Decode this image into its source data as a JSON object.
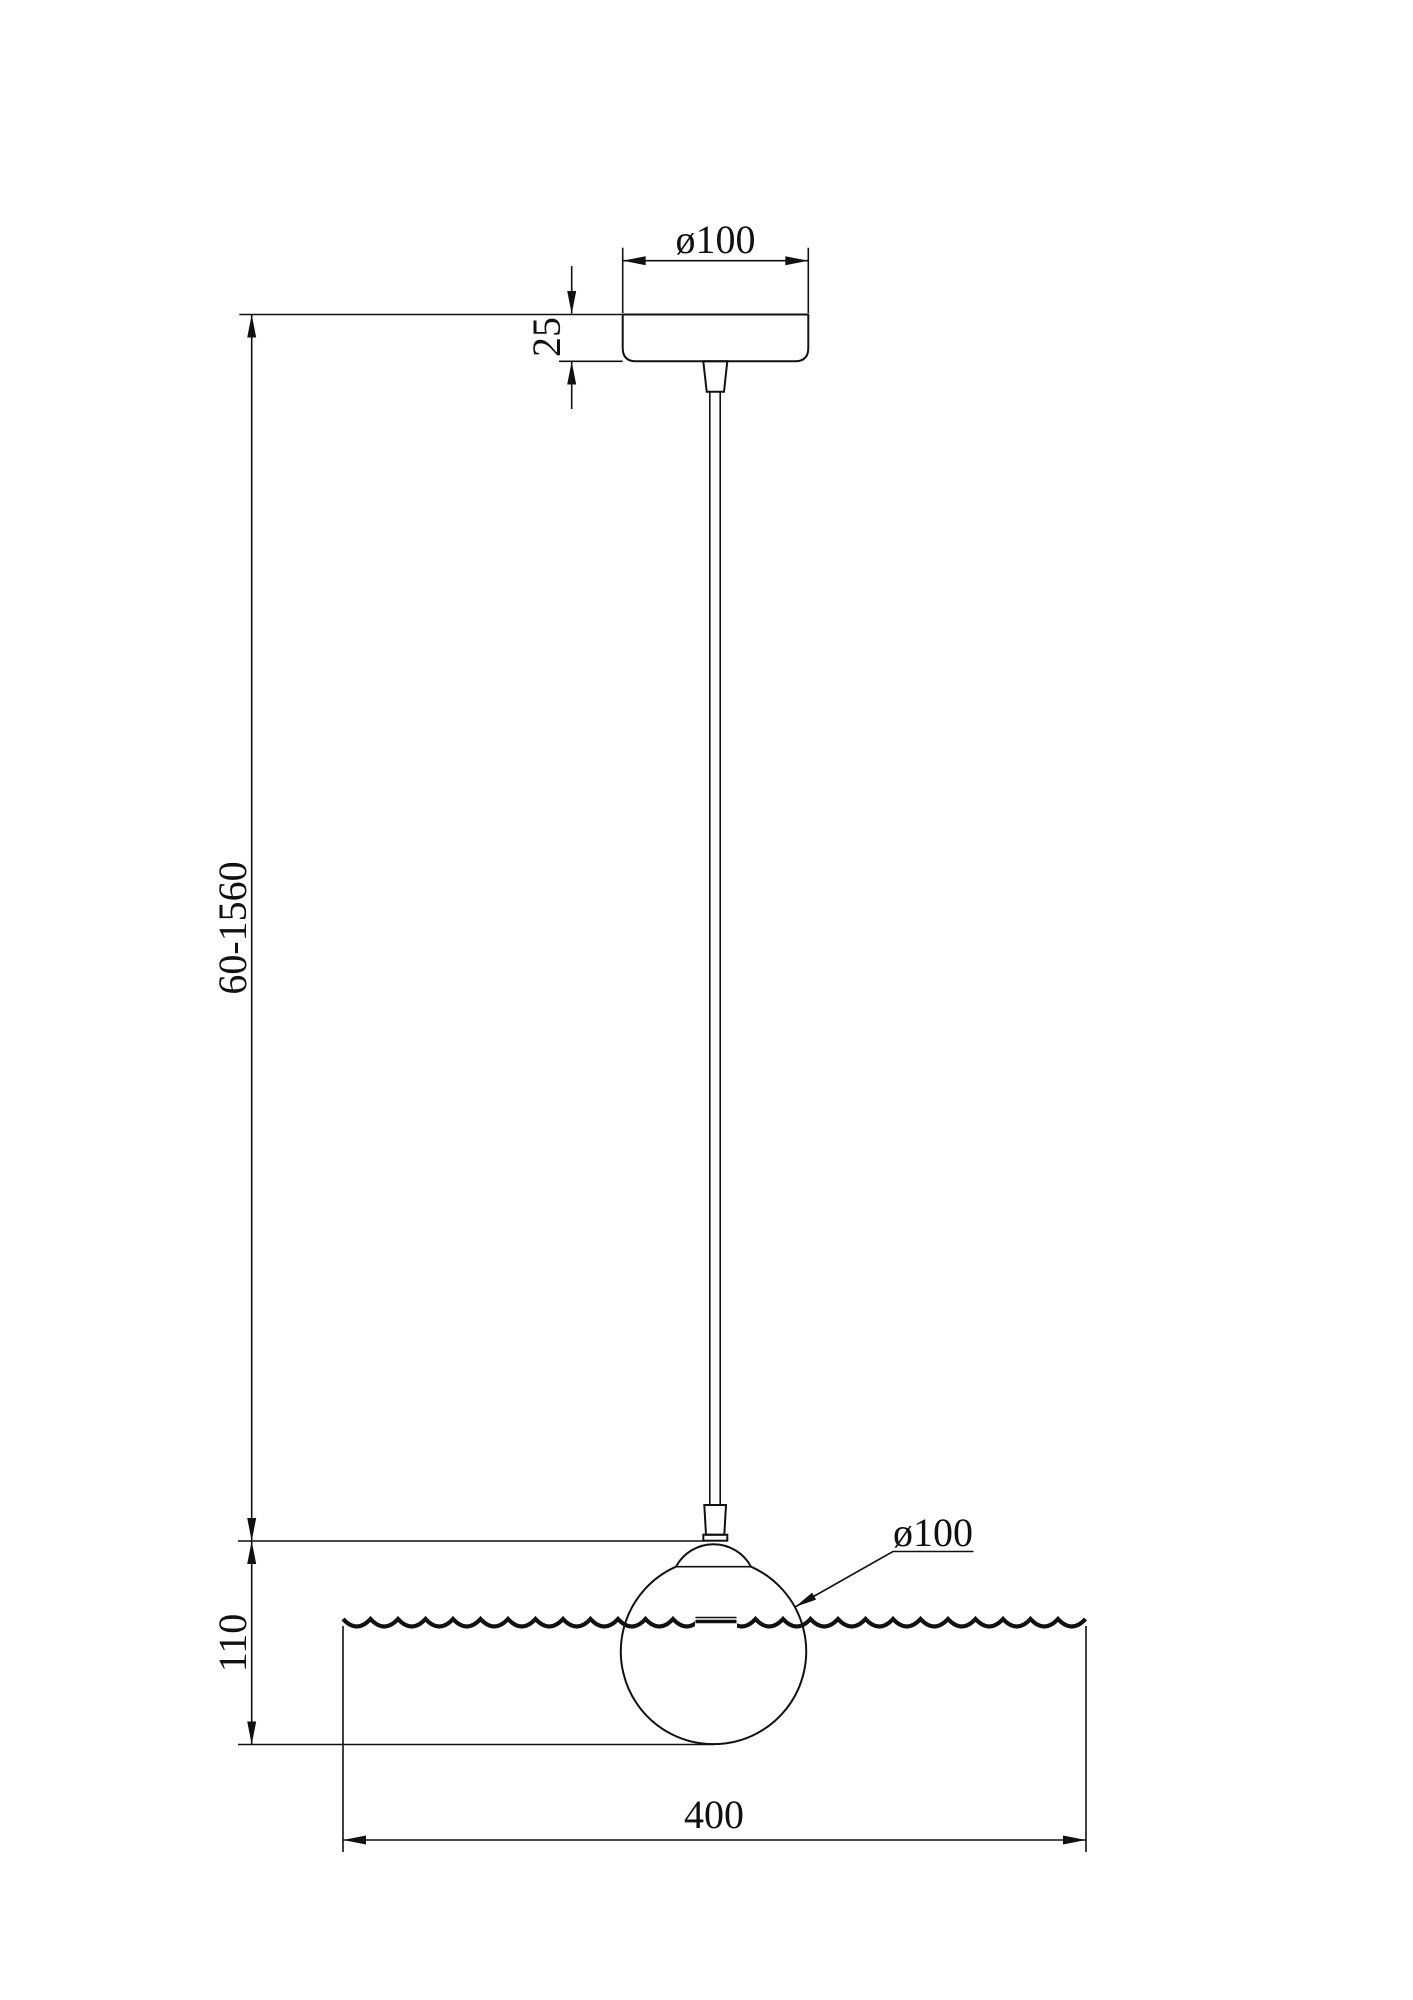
{
  "drawing": {
    "background": "#ffffff",
    "line_color": "#111111",
    "labels": {
      "canopy_diameter": "ø100",
      "canopy_height": "25",
      "suspension_length": "60-1560",
      "shade_drop": "110",
      "shade_diameter": "ø100",
      "panel_width": "400"
    }
  }
}
